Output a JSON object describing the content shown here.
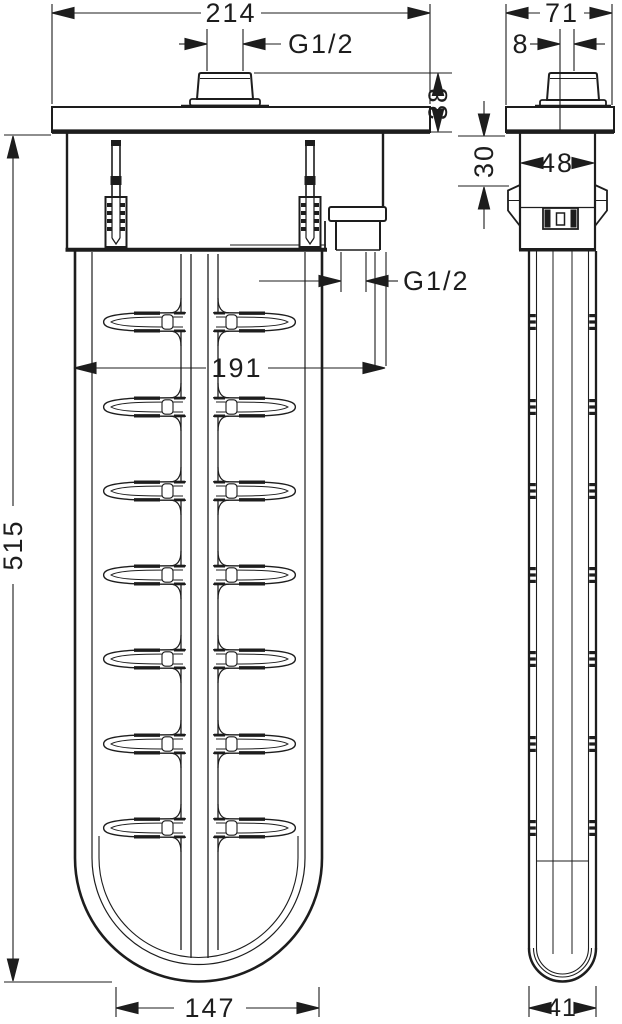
{
  "drawing": {
    "background": "#ffffff",
    "line_color": "#1d1d1d",
    "views": {
      "front": {
        "dimensions": {
          "overall_width": "214",
          "thread_top": "G1/2",
          "plate_thickness": "38",
          "box_width": "191",
          "thread_outlet": "G1/2",
          "body_length": "515",
          "body_width": "147"
        }
      },
      "side": {
        "dimensions": {
          "plate_width": "71",
          "button_offset": "8",
          "housing_width": "48",
          "mounting_depth": "30",
          "shaft_width": "41"
        }
      }
    }
  }
}
